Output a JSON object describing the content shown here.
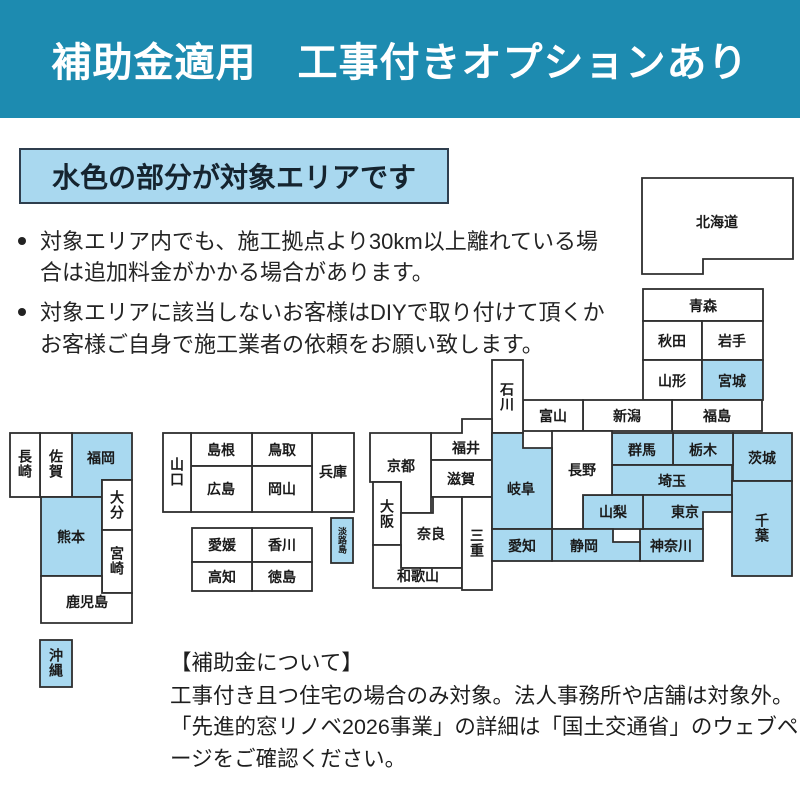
{
  "header": {
    "title": "補助金適用　工事付きオプションあり",
    "bg_color": "#1d8bb0",
    "text_color": "#ffffff"
  },
  "area_banner": {
    "label": "水色の部分が対象エリアです",
    "fill_color": "#a9d8ef",
    "border_color": "#2f3e4e"
  },
  "notes": {
    "bullets": [
      "対象エリア内でも、施工拠点より30km以上離れている場合は追加料金がかかる場合があります。",
      "対象エリアに該当しないお客様はDIYで取り付けて頂くかお客様ご自身で施工業者の依頼をお願い致します。"
    ]
  },
  "map": {
    "highlight_color": "#a9d9f0",
    "default_color": "#ffffff",
    "border_color": "#2e2e2e",
    "prefectures": [
      {
        "label": "北海道",
        "highlighted": false
      },
      {
        "label": "青森",
        "highlighted": false
      },
      {
        "label": "秋田",
        "highlighted": false
      },
      {
        "label": "岩手",
        "highlighted": false
      },
      {
        "label": "山形",
        "highlighted": false
      },
      {
        "label": "宮城",
        "highlighted": true
      },
      {
        "label": "福島",
        "highlighted": false
      },
      {
        "label": "新潟",
        "highlighted": false
      },
      {
        "label": "富山",
        "highlighted": false
      },
      {
        "label": "石川",
        "highlighted": false
      },
      {
        "label": "福井",
        "highlighted": false
      },
      {
        "label": "滋賀",
        "highlighted": false
      },
      {
        "label": "京都",
        "highlighted": false
      },
      {
        "label": "大阪",
        "highlighted": false
      },
      {
        "label": "奈良",
        "highlighted": false
      },
      {
        "label": "和歌山",
        "highlighted": false
      },
      {
        "label": "三重",
        "highlighted": false
      },
      {
        "label": "兵庫",
        "highlighted": false
      },
      {
        "label": "鳥取",
        "highlighted": false
      },
      {
        "label": "島根",
        "highlighted": false
      },
      {
        "label": "岡山",
        "highlighted": false
      },
      {
        "label": "広島",
        "highlighted": false
      },
      {
        "label": "山口",
        "highlighted": false
      },
      {
        "label": "淡路島",
        "highlighted": true
      },
      {
        "label": "香川",
        "highlighted": false
      },
      {
        "label": "愛媛",
        "highlighted": false
      },
      {
        "label": "徳島",
        "highlighted": false
      },
      {
        "label": "高知",
        "highlighted": false
      },
      {
        "label": "福岡",
        "highlighted": true
      },
      {
        "label": "佐賀",
        "highlighted": false
      },
      {
        "label": "長崎",
        "highlighted": false
      },
      {
        "label": "熊本",
        "highlighted": true
      },
      {
        "label": "大分",
        "highlighted": false
      },
      {
        "label": "宮崎",
        "highlighted": false
      },
      {
        "label": "鹿児島",
        "highlighted": false
      },
      {
        "label": "沖縄",
        "highlighted": true
      },
      {
        "label": "茨城",
        "highlighted": true
      },
      {
        "label": "栃木",
        "highlighted": true
      },
      {
        "label": "群馬",
        "highlighted": true
      },
      {
        "label": "埼玉",
        "highlighted": true
      },
      {
        "label": "千葉",
        "highlighted": true
      },
      {
        "label": "東京",
        "highlighted": true
      },
      {
        "label": "神奈川",
        "highlighted": true
      },
      {
        "label": "山梨",
        "highlighted": true
      },
      {
        "label": "長野",
        "highlighted": false
      },
      {
        "label": "岐阜",
        "highlighted": true
      },
      {
        "label": "静岡",
        "highlighted": true
      },
      {
        "label": "愛知",
        "highlighted": true
      }
    ]
  },
  "footer": {
    "heading": "【補助金について】",
    "lines": [
      "工事付き且つ住宅の場合のみ対象。法人事務所や店舗は対象外。",
      "「先進的窓リノベ2026事業」の詳細は「国土交通省」のウェブページをご確認ください。"
    ]
  }
}
